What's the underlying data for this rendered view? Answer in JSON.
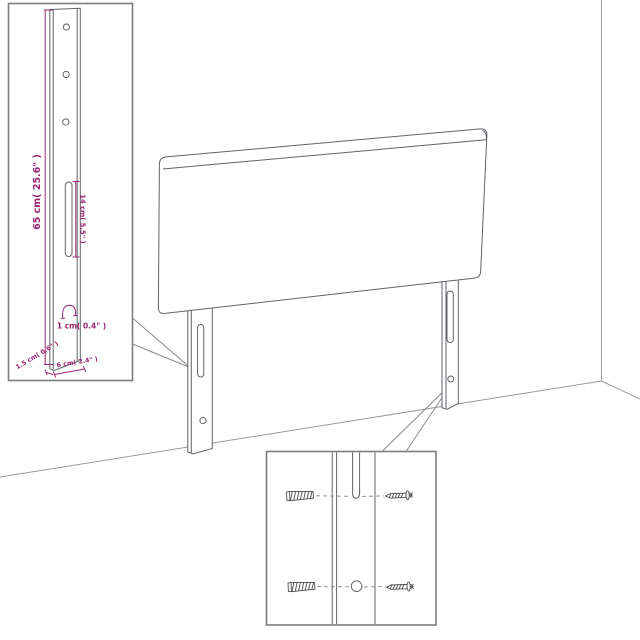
{
  "diagram_type": "headboard-assembly-instruction",
  "colors": {
    "dimension_accent": "#982572",
    "drawing_outline": "#5f6368",
    "wall_line": "#9a9a9a",
    "inset_border": "#7d7d7d",
    "background": "#ffffff"
  },
  "leg_detail_inset": {
    "height_label": "65 cm( 25.6\" )",
    "slot_label": "14 cm( 5.5\" )",
    "hook_label": "1 cm( 0.4\" )",
    "thickness_label": "1.5 cm( 0.6\" )",
    "width_label": "6 cm( 2.4\" )"
  },
  "hardware_inset": {
    "wall_plug_count": 2,
    "screw_count": 2
  },
  "icons": {
    "wall_plug": "wall-plug-icon",
    "screw": "screw-icon"
  }
}
